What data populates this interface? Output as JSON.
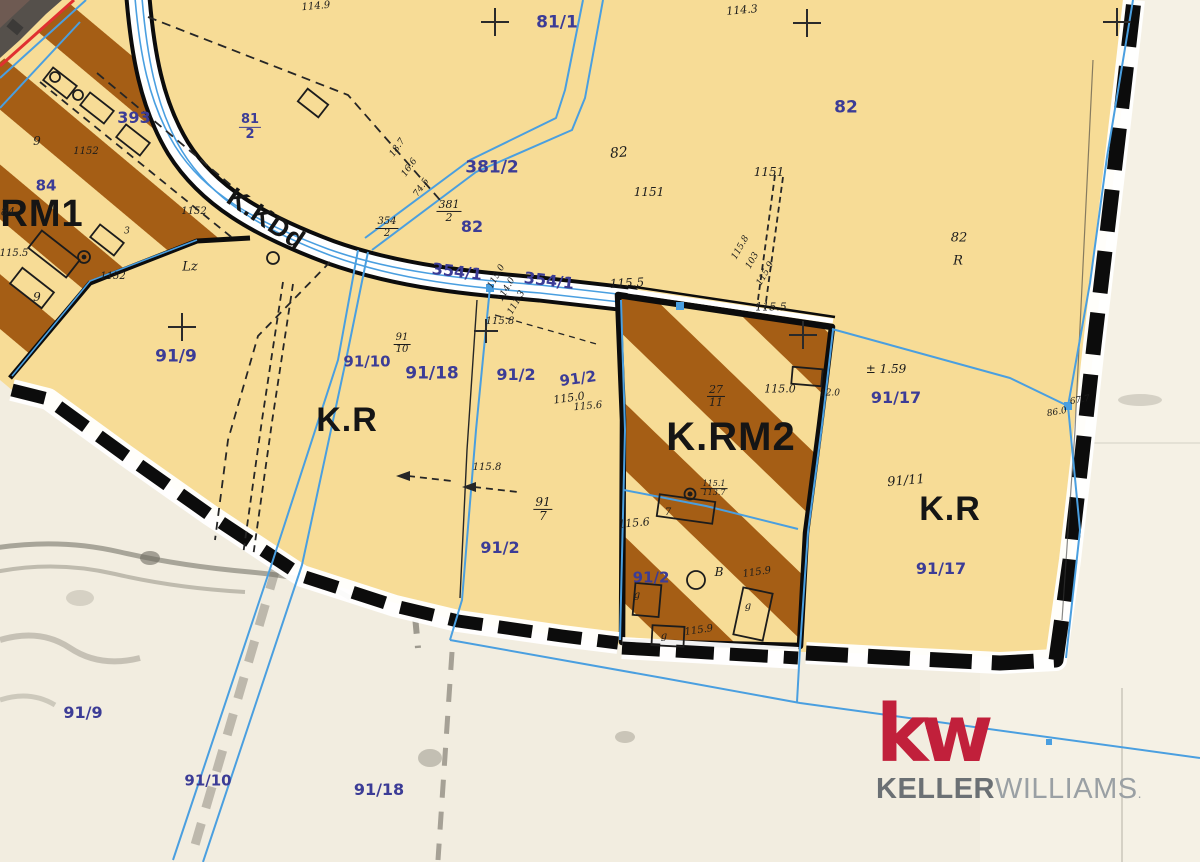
{
  "map": {
    "zone_labels": [
      {
        "t": "K.RM1",
        "x": 22,
        "y": 214,
        "s": 38,
        "r": 0,
        "n": "zone-label-krm1"
      },
      {
        "t": "K.KDd",
        "x": 266,
        "y": 219,
        "s": 27,
        "r": 34,
        "n": "zone-label-kkdd-road"
      },
      {
        "t": "K.R",
        "x": 347,
        "y": 420,
        "s": 34,
        "r": 0,
        "n": "zone-label-kr-west"
      },
      {
        "t": "K.RM2",
        "x": 731,
        "y": 437,
        "s": 40,
        "r": 0,
        "n": "zone-label-krm2"
      },
      {
        "t": "K.R",
        "x": 950,
        "y": 509,
        "s": 34,
        "r": 0,
        "n": "zone-label-kr-east"
      }
    ],
    "parcel_numbers": [
      {
        "t": "81/1",
        "x": 557,
        "y": 23,
        "s": 17
      },
      {
        "t": "82",
        "x": 846,
        "y": 108,
        "s": 17
      },
      {
        "t": "381/2",
        "x": 492,
        "y": 168,
        "s": 17
      },
      {
        "t": "82",
        "x": 472,
        "y": 227,
        "s": 16
      },
      {
        "t": "393",
        "x": 134,
        "y": 118,
        "s": 16
      },
      {
        "t": "84",
        "x": 46,
        "y": 186,
        "s": 15
      },
      {
        "t": "354/1",
        "x": 457,
        "y": 272,
        "s": 16,
        "r": 7
      },
      {
        "t": "354/1",
        "x": 549,
        "y": 281,
        "s": 16,
        "r": 7
      },
      {
        "t": "91/9",
        "x": 176,
        "y": 357,
        "s": 17
      },
      {
        "t": "91/10",
        "x": 367,
        "y": 362,
        "s": 15
      },
      {
        "t": "91/18",
        "x": 432,
        "y": 374,
        "s": 17
      },
      {
        "t": "91/2",
        "x": 516,
        "y": 375,
        "s": 16
      },
      {
        "t": "91/2",
        "x": 578,
        "y": 379,
        "s": 15,
        "r": -8
      },
      {
        "t": "91/17",
        "x": 896,
        "y": 398,
        "s": 16
      },
      {
        "t": "91/2",
        "x": 500,
        "y": 548,
        "s": 16
      },
      {
        "t": "91/2",
        "x": 651,
        "y": 578,
        "s": 15
      },
      {
        "t": "91/17",
        "x": 941,
        "y": 569,
        "s": 16
      },
      {
        "t": "91/9",
        "x": 83,
        "y": 713,
        "s": 16
      },
      {
        "t": "91/10",
        "x": 208,
        "y": 781,
        "s": 15
      },
      {
        "t": "91/18",
        "x": 379,
        "y": 790,
        "s": 16
      }
    ],
    "annotations": [
      {
        "t": "114.9",
        "x": 316,
        "y": 7,
        "s": 10,
        "r": -5
      },
      {
        "t": "114.3",
        "x": 742,
        "y": 10,
        "s": 11,
        "r": -5
      },
      {
        "t": "82",
        "x": 619,
        "y": 153,
        "s": 14,
        "r": -6
      },
      {
        "t": "1151",
        "x": 649,
        "y": 192,
        "s": 12
      },
      {
        "t": "1151",
        "x": 769,
        "y": 172,
        "s": 12
      },
      {
        "t": "115.5",
        "x": 627,
        "y": 283,
        "s": 12,
        "r": -3
      },
      {
        "t": "115.5",
        "x": 771,
        "y": 307,
        "s": 11
      },
      {
        "t": "82",
        "x": 959,
        "y": 238,
        "s": 13
      },
      {
        "t": "R",
        "x": 958,
        "y": 261,
        "s": 13
      },
      {
        "t": "1152",
        "x": 86,
        "y": 152,
        "s": 10
      },
      {
        "t": "1152",
        "x": 194,
        "y": 212,
        "s": 10
      },
      {
        "t": "1152",
        "x": 113,
        "y": 277,
        "s": 10
      },
      {
        "t": "115.5",
        "x": 14,
        "y": 254,
        "s": 10
      },
      {
        "t": "84",
        "x": 8,
        "y": 212,
        "s": 11
      },
      {
        "t": "Lz",
        "x": 190,
        "y": 267,
        "s": 13
      },
      {
        "t": "9",
        "x": 37,
        "y": 141,
        "s": 12
      },
      {
        "t": "9",
        "x": 37,
        "y": 297,
        "s": 12
      },
      {
        "t": "3",
        "x": 127,
        "y": 232,
        "s": 9
      },
      {
        "t": "115.8",
        "x": 500,
        "y": 322,
        "s": 10
      },
      {
        "t": "115.0",
        "x": 569,
        "y": 398,
        "s": 11,
        "r": -8
      },
      {
        "t": "115.6",
        "x": 588,
        "y": 407,
        "s": 10,
        "r": -5
      },
      {
        "t": "115.8",
        "x": 487,
        "y": 468,
        "s": 10
      },
      {
        "t": "115.6",
        "x": 634,
        "y": 523,
        "s": 11,
        "r": -5
      },
      {
        "t": "115.0",
        "x": 780,
        "y": 389,
        "s": 11
      },
      {
        "t": "12.0",
        "x": 830,
        "y": 394,
        "s": 9
      },
      {
        "t": "± 1.59",
        "x": 886,
        "y": 369,
        "s": 12
      },
      {
        "t": "86.0",
        "x": 1057,
        "y": 413,
        "s": 9,
        "r": -10
      },
      {
        "t": "67.7",
        "x": 1080,
        "y": 401,
        "s": 9,
        "r": -10
      },
      {
        "t": "91/11",
        "x": 906,
        "y": 481,
        "s": 13,
        "r": -5
      },
      {
        "t": "B",
        "x": 719,
        "y": 572,
        "s": 12
      },
      {
        "t": "115.9",
        "x": 757,
        "y": 573,
        "s": 10,
        "r": -8
      },
      {
        "t": "115.9",
        "x": 699,
        "y": 631,
        "s": 10,
        "r": -8
      },
      {
        "t": "g",
        "x": 637,
        "y": 596,
        "s": 10
      },
      {
        "t": "g",
        "x": 664,
        "y": 637,
        "s": 10
      },
      {
        "t": "g",
        "x": 748,
        "y": 607,
        "s": 10
      },
      {
        "t": "7",
        "x": 668,
        "y": 513,
        "s": 10
      },
      {
        "t": "18.7",
        "x": 398,
        "y": 148,
        "s": 9,
        "r": -55
      },
      {
        "t": "16.6",
        "x": 410,
        "y": 168,
        "s": 9,
        "r": -55
      },
      {
        "t": "74.5",
        "x": 422,
        "y": 188,
        "s": 9,
        "r": -55
      },
      {
        "t": "115.0",
        "x": 497,
        "y": 277,
        "s": 9,
        "r": -60
      },
      {
        "t": "114.0",
        "x": 507,
        "y": 290,
        "s": 9,
        "r": -60
      },
      {
        "t": "111.3",
        "x": 517,
        "y": 303,
        "s": 9,
        "r": -60
      },
      {
        "t": "115.8",
        "x": 741,
        "y": 248,
        "s": 9,
        "r": -60
      },
      {
        "t": "103",
        "x": 753,
        "y": 261,
        "s": 9,
        "r": -60
      },
      {
        "t": "115.9",
        "x": 766,
        "y": 274,
        "s": 9,
        "r": -60
      }
    ],
    "fractions": [
      {
        "top": "81",
        "bot": "2",
        "x": 250,
        "y": 127,
        "s": 13,
        "cls": "pur"
      },
      {
        "top": "381",
        "bot": "2",
        "x": 449,
        "y": 211,
        "s": 11,
        "cls": ""
      },
      {
        "top": "354",
        "bot": "2",
        "x": 387,
        "y": 228,
        "s": 10,
        "cls": ""
      },
      {
        "top": "91",
        "bot": "10",
        "x": 402,
        "y": 344,
        "s": 10,
        "cls": ""
      },
      {
        "top": "91",
        "bot": "7",
        "x": 543,
        "y": 509,
        "s": 12,
        "cls": ""
      },
      {
        "top": "27",
        "bot": "11",
        "x": 716,
        "y": 396,
        "s": 11,
        "cls": ""
      },
      {
        "top": "115.1",
        "bot": "113.7",
        "x": 714,
        "y": 489,
        "s": 8,
        "cls": ""
      }
    ],
    "colors": {
      "zone_fill": "#f7dc96",
      "stripe_brown": "#a55e15",
      "outside": "#f2ede0",
      "blue_line": "#4a9fe0",
      "parcel_text": "#3c3c96",
      "boundary_black": "#0c0c0c",
      "red_line": "#e03030"
    }
  },
  "logo": {
    "mark": "kw",
    "name_bold": "KELLER",
    "name_light": "WILLIAMS",
    "suffix": "."
  }
}
